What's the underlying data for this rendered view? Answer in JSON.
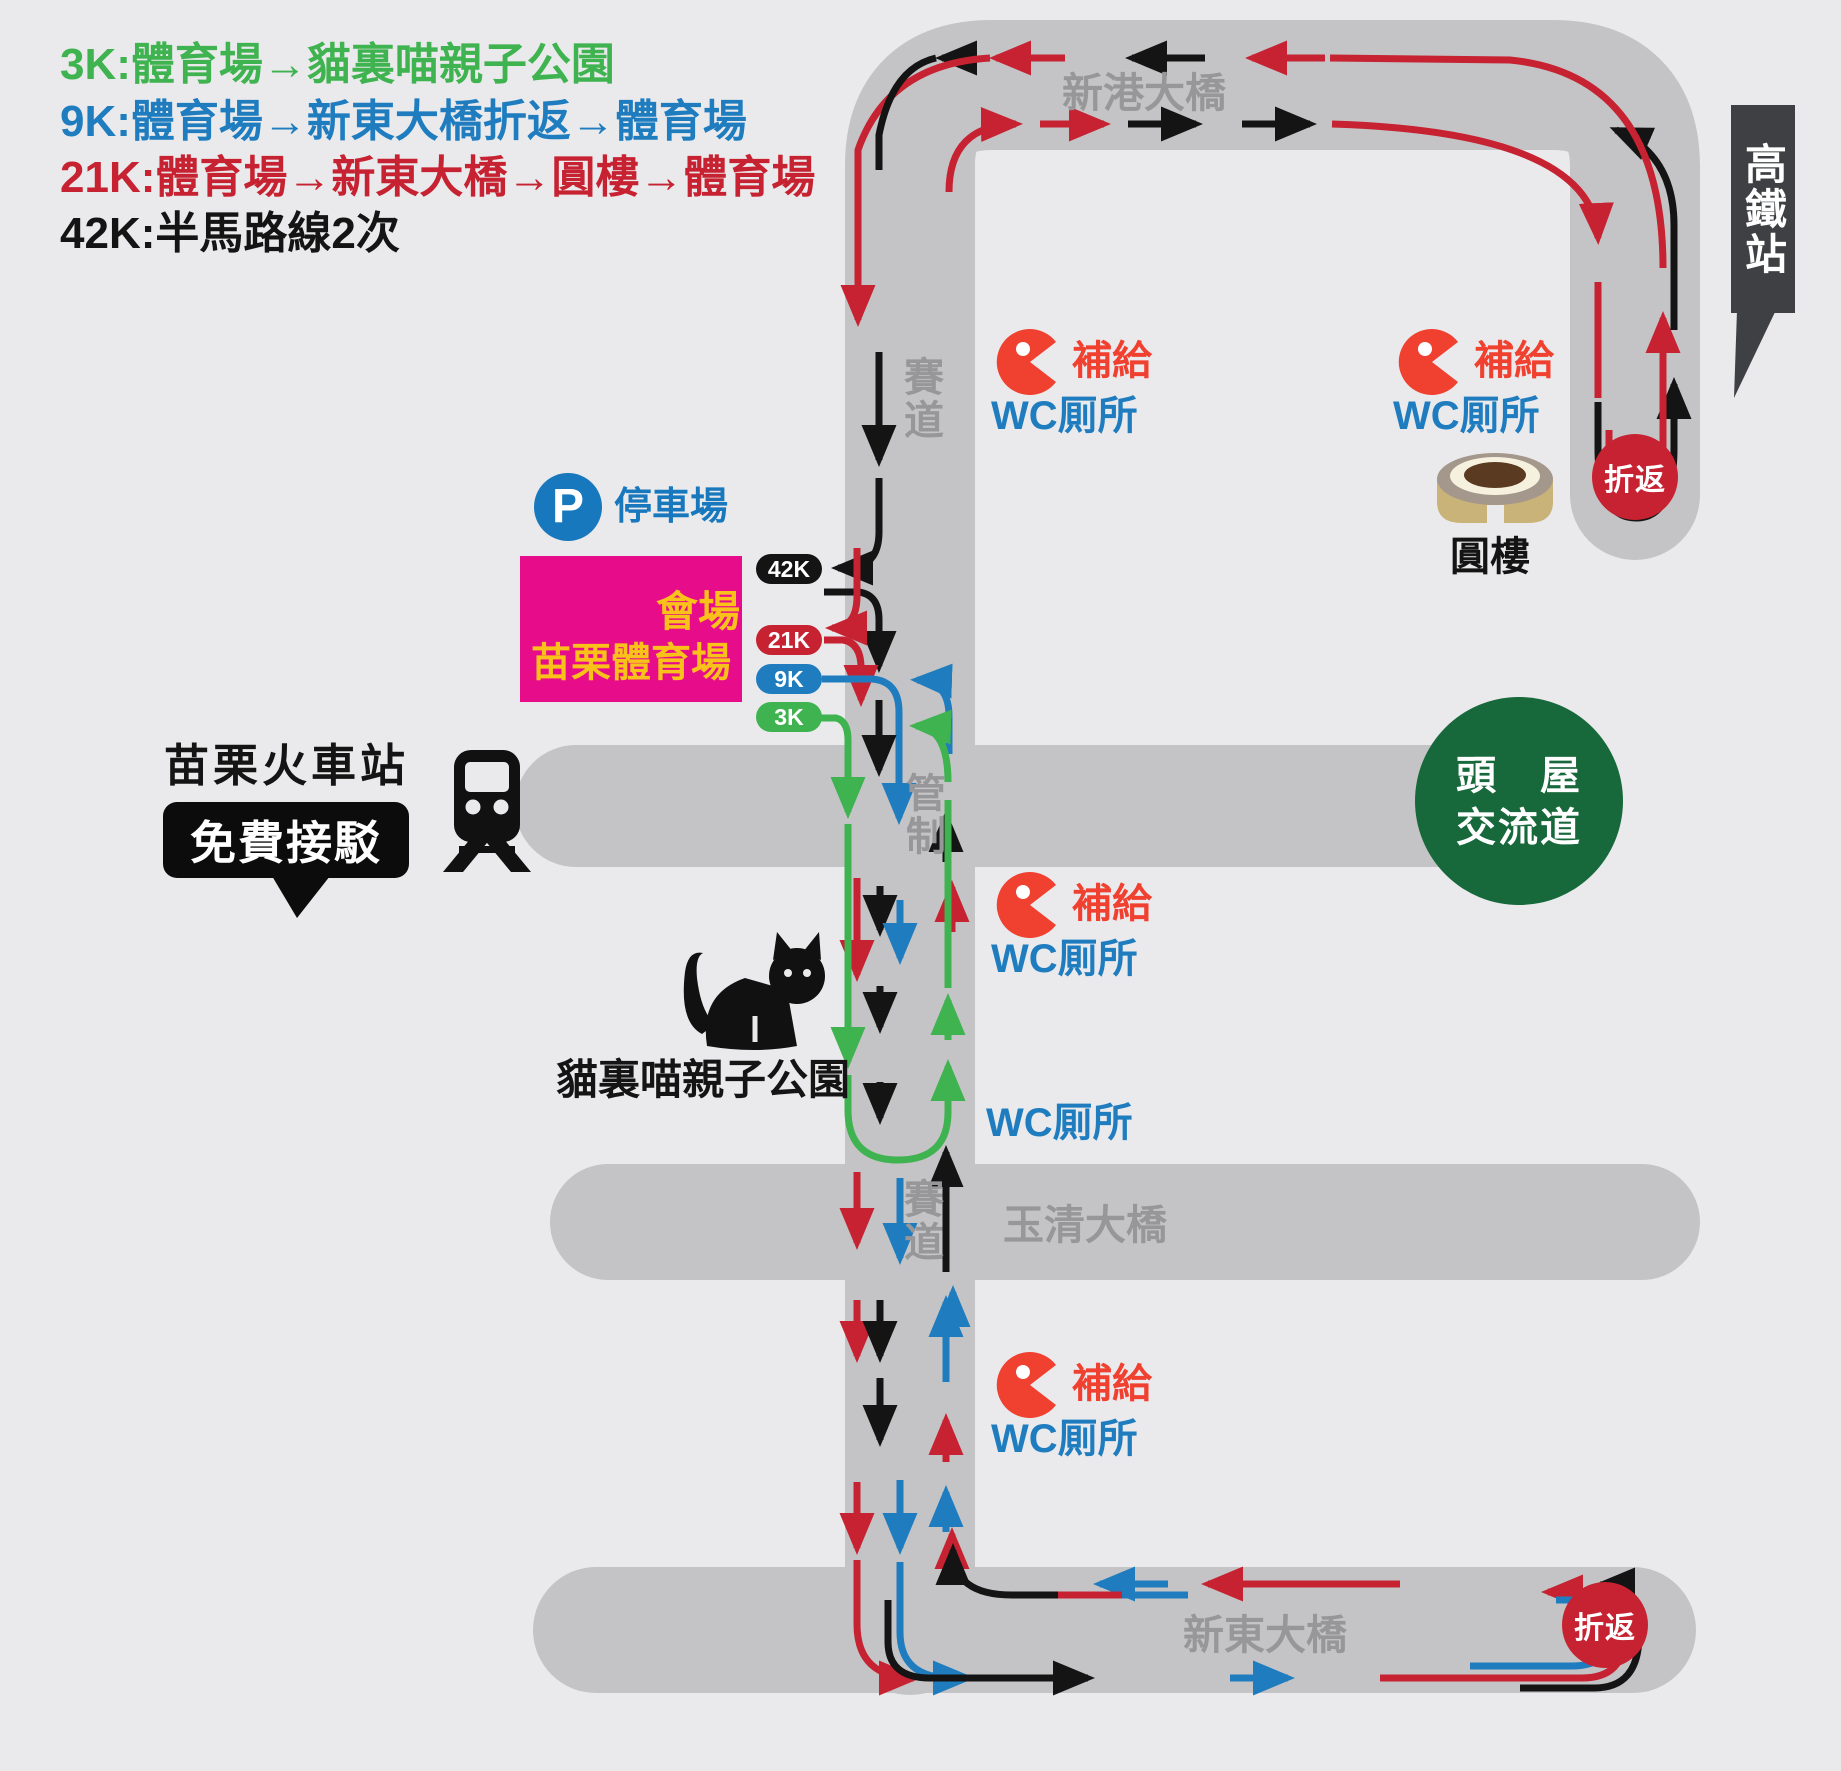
{
  "title_legend": [
    {
      "label": "3K:體育場→貓裏喵親子公園",
      "color": "#3fb34f"
    },
    {
      "label": "9K:體育場→新東大橋折返→體育場",
      "color": "#1f7dbf"
    },
    {
      "label": "21K:體育場→新東大橋→圓樓→體育場",
      "color": "#c62231"
    },
    {
      "label": "42K:半馬路線2次",
      "color": "#141414"
    }
  ],
  "roads": {
    "xingang": "新港大橋",
    "yuqing": "玉清大橋",
    "xindong": "新東大橋",
    "course_label": "賽道",
    "control_label": "管制"
  },
  "places": {
    "hsr": "高鐵站",
    "roundhouse": "圓樓",
    "interchange_line1": "頭　屋",
    "interchange_line2": "交流道",
    "train_station": "苗栗火車站",
    "shuttle": "免費接駁",
    "cat_park": "貓裏喵親子公園",
    "parking": "停車場",
    "parking_initial": "P",
    "venue": "會場",
    "stadium": "苗栗體育場"
  },
  "course": {
    "turnaround": "折返",
    "supply": "補給",
    "wc": "WC厠所"
  },
  "checkpoints": [
    {
      "label": "42K",
      "color": "#141414"
    },
    {
      "label": "21K",
      "color": "#c62231"
    },
    {
      "label": "9K",
      "color": "#1f7dbf"
    },
    {
      "label": "3K",
      "color": "#3fb34f"
    }
  ],
  "route_colors": {
    "k3": "#3fb34f",
    "k9": "#1f7dbf",
    "k21": "#c62231",
    "k42": "#141414"
  },
  "map_colors": {
    "road": "#c4c4c6",
    "background": "#eaeaec",
    "road_label": "#97979a"
  }
}
